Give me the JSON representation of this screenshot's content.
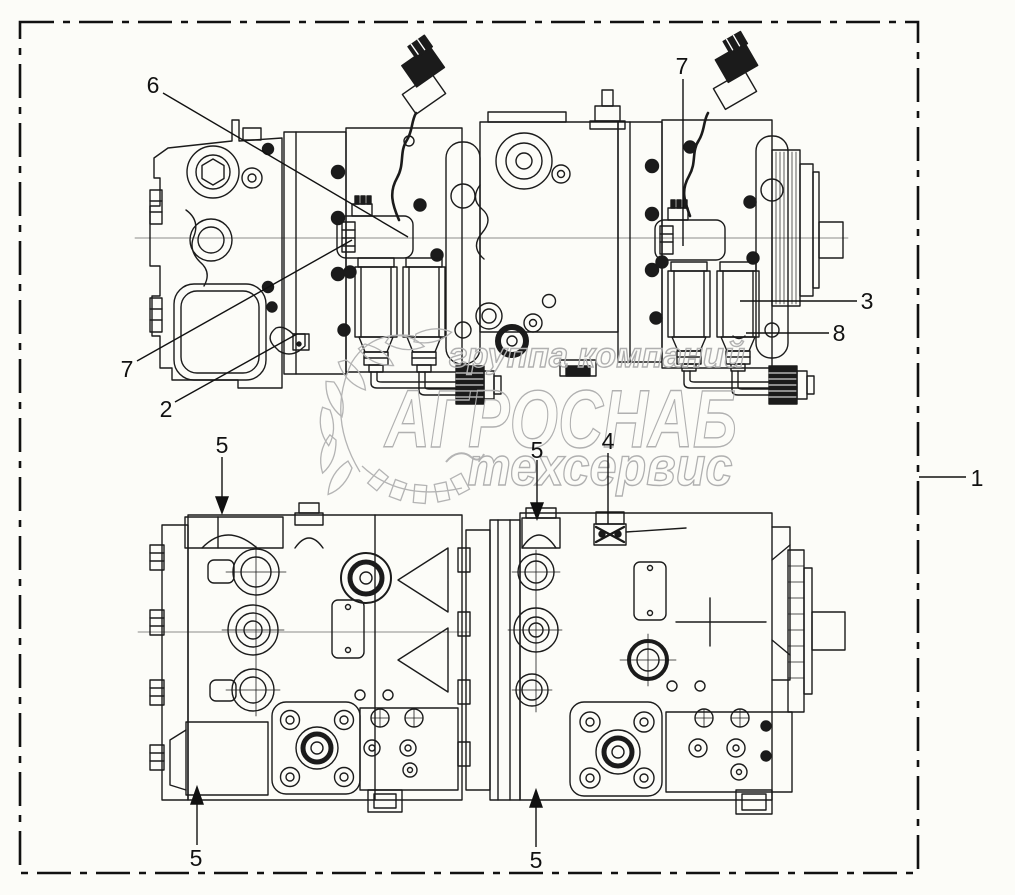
{
  "diagram": {
    "callouts": {
      "n1": "1",
      "n2": "2",
      "n3": "3",
      "n4": "4",
      "n5": "5",
      "n6": "6",
      "n7": "7",
      "n8": "8"
    },
    "watermark": {
      "top_line": "группа компаний",
      "main_line": "АГРОСНАБ",
      "bottom_line": "техсервис"
    },
    "colors": {
      "line": "#1b1b1b",
      "watermark": "#b0b0b0",
      "background": "#fcfcf8"
    }
  }
}
